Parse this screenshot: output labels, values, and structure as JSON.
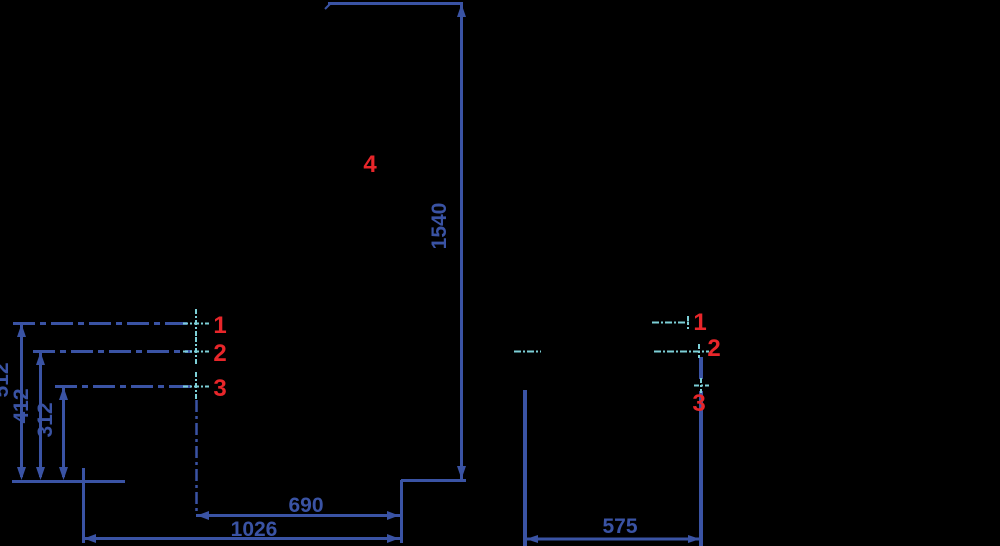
{
  "drawing": {
    "background": "#000000",
    "colors": {
      "dimension_blue": "#3a53a4",
      "centerline_cyan": "#7ccfd6",
      "label_red": "#e8262a"
    },
    "front_view": {
      "labels": {
        "hole1": "1",
        "hole2": "2",
        "hole3": "3",
        "point4": "4"
      },
      "dimensions": {
        "total_height": "1540",
        "hole1_height": "512",
        "hole2_height": "412",
        "hole3_height": "312",
        "hole_to_right_edge": "690",
        "overall_width": "1026"
      }
    },
    "side_view": {
      "labels": {
        "hole1": "1",
        "hole2": "2",
        "hole3": "3"
      },
      "dimensions": {
        "depth": "575"
      }
    }
  }
}
